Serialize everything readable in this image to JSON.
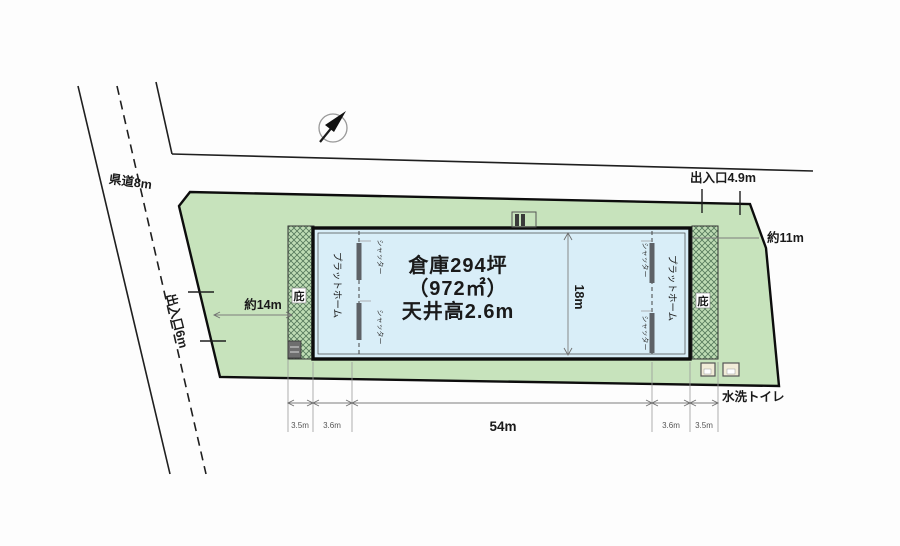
{
  "figure": {
    "road_label": "県道8m",
    "entrance_west": "出入口6m",
    "entrance_north": "出入口4.9m",
    "dim_west_approach": "約14m",
    "dim_east_side": "約11m",
    "dim_length": "54m",
    "dim_depth": "18m",
    "dim_left_eave": "3.5m",
    "dim_left_platform": "3.6m",
    "dim_right_platform": "3.6m",
    "dim_right_eave": "3.5m",
    "warehouse_title": "倉庫294坪",
    "warehouse_area": "（972㎡）",
    "warehouse_ceiling": "天井高2.6m",
    "platform": "プラットホーム",
    "shutter": "シャッター",
    "eave": "庇",
    "toilet": "水洗トイレ",
    "colors": {
      "site_green": "#c7e3bc",
      "warehouse_blue": "#d9eef8",
      "hatch_green": "#bedcb4",
      "line_black": "#111111"
    }
  }
}
